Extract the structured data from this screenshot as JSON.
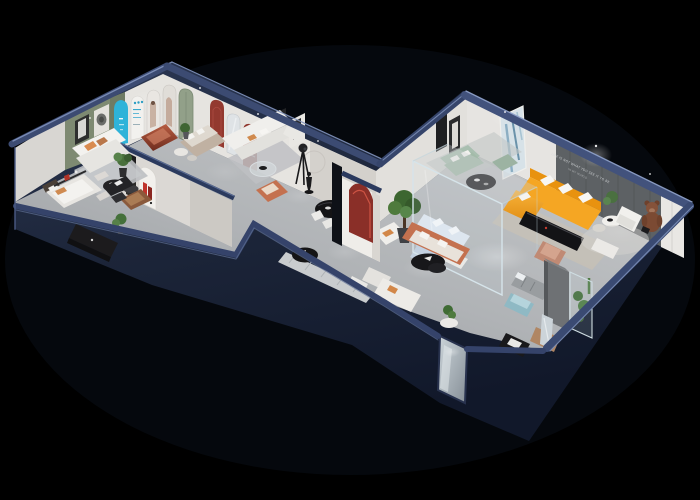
{
  "scene": {
    "title": "isometric-showroom-floorplan-render",
    "background_color": "#000000",
    "wing_count": 2,
    "accent_wall": {
      "tagline_line1": "LIFE IS NOT WHAT YOU SEE IT TO BE",
      "tagline_line2": "IN MY WORLD"
    },
    "palette": {
      "outer_wall_navy": "#1d2740",
      "wall_top_band": "#3a4a70",
      "wall_edge_highlight": "#8294bc",
      "floor_gray": "#b4b6b9",
      "interior_wall_white": "#e6e4e0",
      "green_wall": "#7e8a72",
      "accent_wall_gray": "#5d6164",
      "sofa_orange": "#f5a623",
      "sofa_sage": "#a9bfb0",
      "sofa_terracotta": "#c4714f",
      "arch_cyan": "#2fb3d9",
      "arch_red": "#93392f",
      "ottoman_copper": "#a34e38",
      "ottoman_teal": "#8fb9c4",
      "plant_green": "#4c7040",
      "teddy_brown": "#7b4a33"
    },
    "left_wing": {
      "rooms": [
        {
          "name": "arch-gallery-lounge",
          "wall_features": [
            "green-feature-wall",
            "framed-art",
            "disc-art",
            "cyan-arch-panel",
            "blue-text-arch-poster",
            "photo-arch-posters",
            "green-door",
            "red-arch-niche",
            "arched-mirror"
          ],
          "furniture": [
            "white-sofa",
            "orange-pillows",
            "black-coffee-table",
            "copper-ottoman",
            "tan-sofa",
            "round-side-tables",
            "potted-plant",
            "gray-rug"
          ]
        },
        {
          "name": "white-sofa-lounge",
          "furniture": [
            "white-corner-sofa",
            "glass-round-table",
            "tripod-spotlight",
            "terracotta-armchair",
            "black-art-frames",
            "wall-ring-decor",
            "figure-statue",
            "gray-rug"
          ]
        },
        {
          "name": "bedroom-display",
          "furniture": [
            "white-bed",
            "orange-cushion",
            "dark-headboard",
            "black-tv-console",
            "wall-shelf-red-books",
            "side-table"
          ]
        },
        {
          "name": "study-corner",
          "furniture": [
            "brown-leather-armchair",
            "black-desk",
            "black-chair",
            "red-letter-arch-poster",
            "potted-plant"
          ]
        }
      ]
    },
    "center_corridor": {
      "features": [
        "black-round-dining-table",
        "white-dining-chairs",
        "striped-runner-rug",
        "black-round-ottoman",
        "white-armchair",
        "pillar-red-arch-niche",
        "potted-tree",
        "mirror-door-panel",
        "wall-gap-console"
      ]
    },
    "right_wing": {
      "rooms": [
        {
          "name": "main-showroom",
          "furniture": [
            "orange-l-sofa",
            "white-pillows",
            "sage-sofa-set",
            "black-round-coffee-table",
            "blue-abstract-art",
            "black-art-frames",
            "black-media-console",
            "white-round-tables",
            "white-armchair",
            "teddy-bear-chair",
            "white-side-table",
            "beige-rug",
            "white-rug"
          ]
        },
        {
          "name": "glass-showcase",
          "furniture": [
            "light-blue-sectional-sofa",
            "white-coffee-table",
            "glass-walls"
          ]
        },
        {
          "name": "lower-gallery",
          "furniture": [
            "terracotta-sofa",
            "black-organic-coffee-table",
            "white-armchairs",
            "teal-ottoman",
            "gray-striped-bench",
            "gray-partition-wall",
            "glass-display-case",
            "plants",
            "tan-recliner",
            "black-magazine-table",
            "wood-console",
            "standing-mirror"
          ]
        }
      ]
    }
  }
}
